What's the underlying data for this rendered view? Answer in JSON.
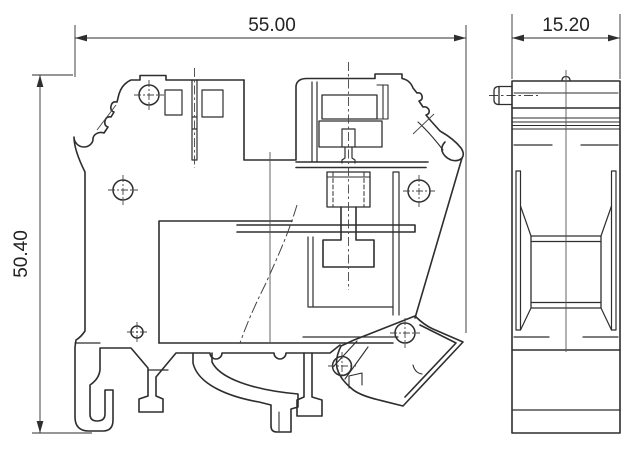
{
  "drawing": {
    "title_visible_text": "",
    "dimensions": {
      "top_width": "55.00",
      "left_height": "50.40",
      "side_width": "15.20"
    },
    "colors": {
      "background": "#ffffff",
      "line": "#2e2e2e",
      "thin_line": "#555555",
      "text": "#222222"
    }
  }
}
